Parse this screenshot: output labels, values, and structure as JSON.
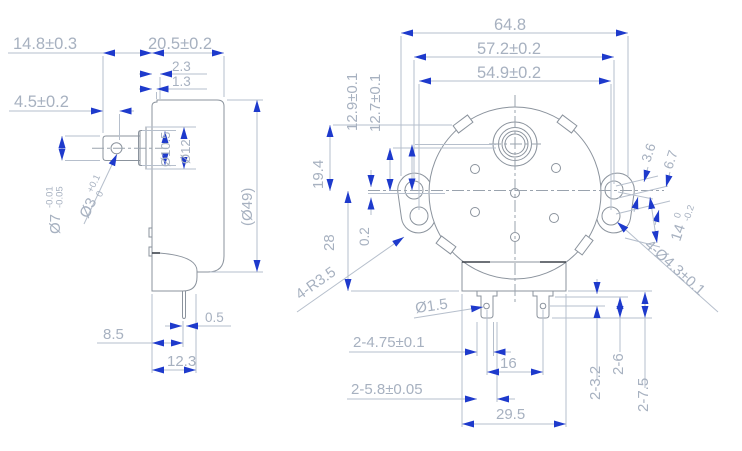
{
  "drawing_title": "synchronous motor outline dimension drawing",
  "colors": {
    "geometry_line": "#8b939d",
    "dimension_line": "#b6bfcc",
    "dimension_text": "#a7b1c0",
    "arrow": "#1e3acc",
    "dark_edge": "#3e444c"
  },
  "side": {
    "d14_8": "14.8±0.3",
    "d20_5": "20.5±0.2",
    "d2_3": "2.3",
    "d1_3": "1.3",
    "d4_5": "4.5±0.2",
    "shaft_dia": "Ø7",
    "shaft_tol_hi": "-0.01",
    "shaft_tol_lo": "-0.05",
    "hole_dia": "Ø3",
    "hole_tol_hi": "+0.1",
    "hole_tol_lo": "0",
    "boss1": "Ø10.5",
    "boss2": "Ø12",
    "body_dia": "(Ø49)",
    "pin_w": "0.5",
    "pin_off": "8.5",
    "box_d": "12.3"
  },
  "front": {
    "w_total": "64.8",
    "w_outer": "57.2±0.2",
    "w_inner": "54.9±0.2",
    "h1": "12.9±0.1",
    "h2": "12.7±0.1",
    "h_tab": "19.4",
    "h_box": "28",
    "h_off": "0.2",
    "ear_r": "4-R3.5",
    "e1": "3.6",
    "e2": "6.7",
    "ear_span": "14",
    "ear_tol_hi": "0",
    "ear_tol_lo": "-0.2",
    "mount_holes": "4-Ø4.3±0.1",
    "pin_hole": "Ø1.5",
    "pin_w": "2-4.75±0.1",
    "pin_pitch": "16",
    "pin_t": "2-5.8±0.05",
    "box_w": "29.5",
    "v1": "2-3.2",
    "v2": "2-6",
    "v3": "2-7.5"
  }
}
